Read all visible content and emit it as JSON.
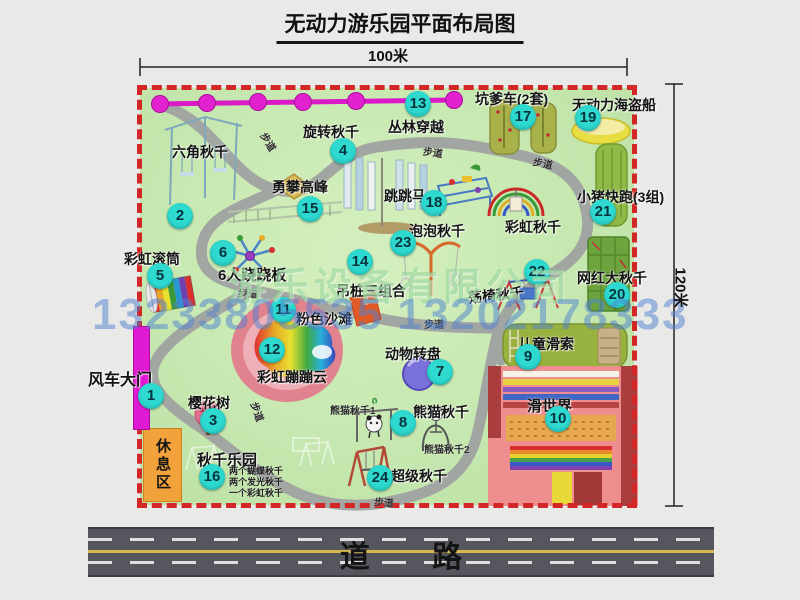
{
  "title": "无动力游乐园平面布局图",
  "dims": {
    "top": "100米",
    "right": "120米"
  },
  "road": {
    "label": "道 路"
  },
  "watermark": {
    "company": "游乐设备有限公司",
    "phone": "13233805535 13202178333"
  },
  "rest_area": "休息区",
  "path_label": "步道",
  "rainbow_swing": "彩虹秋千",
  "notes": {
    "swing_park": [
      "两个蝴蝶秋千",
      "两个发光秋千",
      "一个彩虹秋千"
    ],
    "panda": [
      "熊猫秋千1",
      "熊猫秋千2"
    ]
  },
  "attractions": [
    {
      "num": "1",
      "name": "风车大门"
    },
    {
      "num": "2",
      "name": "六角秋千"
    },
    {
      "num": "3",
      "name": "樱花树"
    },
    {
      "num": "4",
      "name": "旋转秋千"
    },
    {
      "num": "5",
      "name": "彩虹滚筒"
    },
    {
      "num": "6",
      "name": "6人跷跷板"
    },
    {
      "num": "7",
      "name": "动物转盘"
    },
    {
      "num": "8",
      "name": "熊猫秋千"
    },
    {
      "num": "9",
      "name": "儿童滑索"
    },
    {
      "num": "10",
      "name": "滑世界"
    },
    {
      "num": "11",
      "name": "粉色沙滩"
    },
    {
      "num": "12",
      "name": "彩虹蹦蹦云"
    },
    {
      "num": "13",
      "name": "丛林穿越"
    },
    {
      "num": "14",
      "name": "吊桩三组合"
    },
    {
      "num": "15",
      "name": "勇攀高峰"
    },
    {
      "num": "16",
      "name": "秋千乐园"
    },
    {
      "num": "17",
      "name": "坑爹车(2套)"
    },
    {
      "num": "18",
      "name": "跳跳马"
    },
    {
      "num": "19",
      "name": "无动力海盗船"
    },
    {
      "num": "20",
      "name": "网红大秋千"
    },
    {
      "num": "21",
      "name": "小猪快跑(3组)"
    },
    {
      "num": "22",
      "name": "荡椅秋千"
    },
    {
      "num": "23",
      "name": "泡泡秋千"
    },
    {
      "num": "24",
      "name": "超级秋千"
    }
  ],
  "colors": {
    "grass": "#c6e8b0",
    "border_dash": "#d32626",
    "badge": "#2edad0",
    "chain_magenta": "#e322cf",
    "road_asphalt": "#56565e",
    "rest_area_orange": "#f2a23a"
  }
}
